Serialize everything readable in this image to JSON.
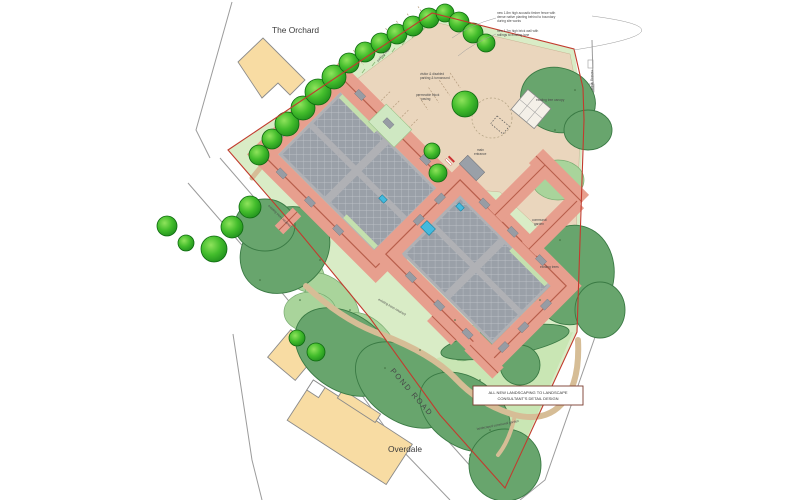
{
  "labels": {
    "area_top": "The Orchard",
    "road": "POND ROAD",
    "area_bottom": "Overdale"
  },
  "note_box": {
    "line1": "ALL NEW LANDSCAPING TO LANDSCAPE",
    "line2": "CONSULTANT'S DETAIL DESIGN"
  },
  "annotations": [
    {
      "text": "new 1.8m high acoustic timber fence with"
    },
    {
      "text": "dense native planting behind to boundary"
    },
    {
      "text": "during site works"
    },
    {
      "text": "new 1.2m high brick wall with"
    },
    {
      "text": "railings to existing lane"
    },
    {
      "text": "parking bays"
    },
    {
      "text": "visitor & disabled"
    },
    {
      "text": "parking & turnaround"
    },
    {
      "text": "permeable block"
    },
    {
      "text": "paving"
    },
    {
      "text": "main"
    },
    {
      "text": "entrance"
    },
    {
      "text": "existing tree canopy"
    },
    {
      "text": "existing trees retained"
    },
    {
      "text": "existing trees retained"
    },
    {
      "text": "landscaped communal garden"
    },
    {
      "text": "existing trees"
    },
    {
      "text": "communal"
    },
    {
      "text": "garden"
    },
    {
      "text": "existing hedge"
    }
  ],
  "colors": {
    "boundary_red": "#c23b2e",
    "roof_salmon": "#e79f8e",
    "roof_ridge": "#b85f4c",
    "courtyard_gray": "#b0b1b5",
    "hatch_gray": "#9aa0a8",
    "water_cyan": "#44bade",
    "parking_tan": "#ead6bd",
    "path_tan": "#d6bd96",
    "lawn_green": "#d9ecc6",
    "garden_green": "#c9e6b4",
    "canopy_dark": "#68a56d",
    "shrub_mid": "#a9d49b",
    "tree_bright": "#3cb52f",
    "building_cream": "#f8dca3",
    "road_line_gray": "#9b9b9b"
  }
}
